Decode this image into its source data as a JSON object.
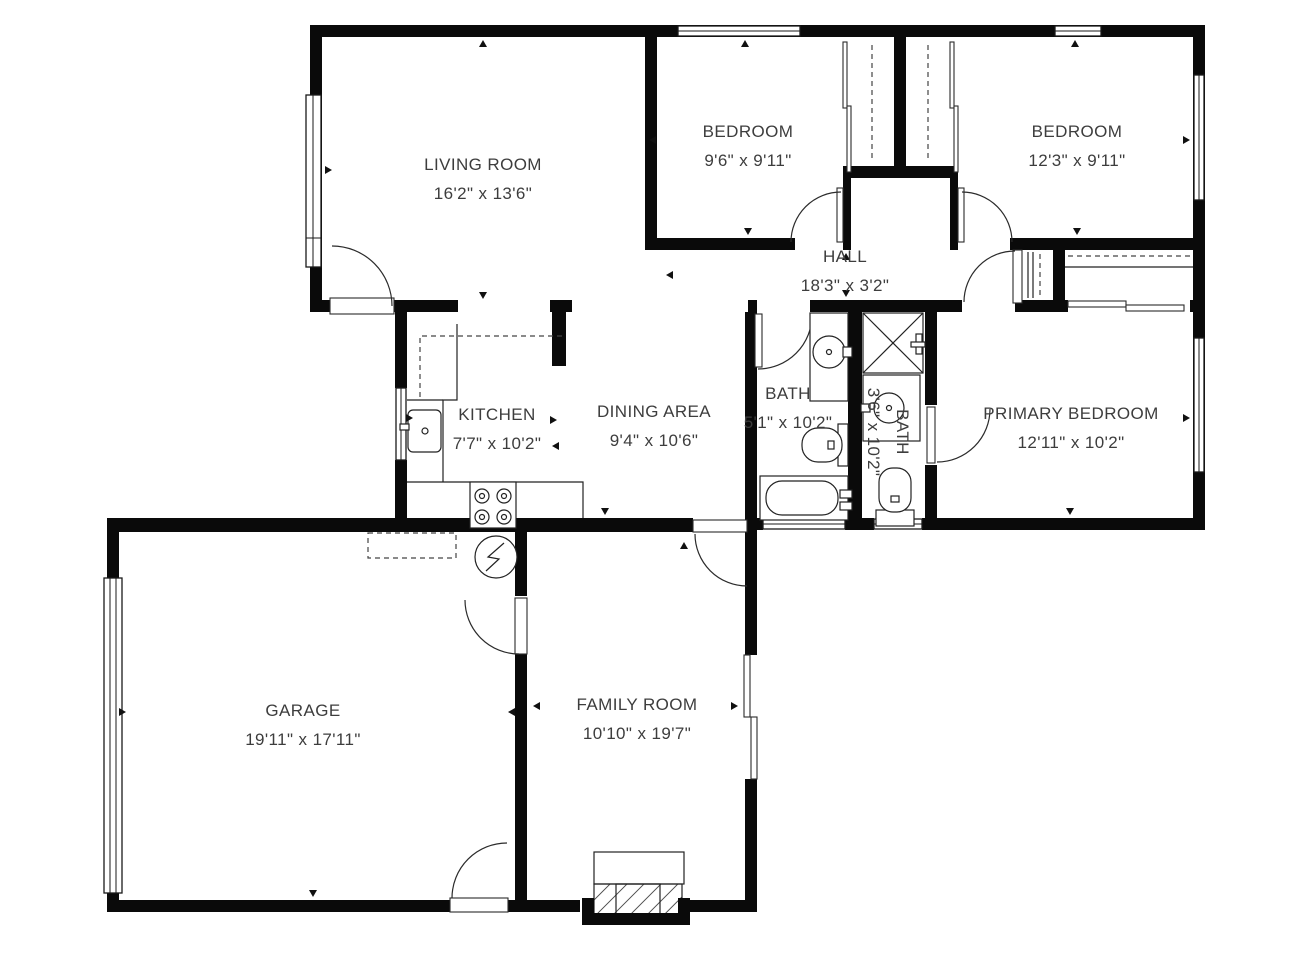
{
  "plan": {
    "background": "#ffffff",
    "wall_color": "#0a0a0a",
    "label_color": "#3d3d3d"
  },
  "rooms": [
    {
      "id": "living-room",
      "name": "LIVING ROOM",
      "dims": "16'2\" x 13'6\"",
      "cx": 483,
      "cy": 170,
      "rotate": 0
    },
    {
      "id": "bedroom-1",
      "name": "BEDROOM",
      "dims": "9'6\" x 9'11\"",
      "cx": 748,
      "cy": 137,
      "rotate": 0
    },
    {
      "id": "bedroom-2",
      "name": "BEDROOM",
      "dims": "12'3\" x 9'11\"",
      "cx": 1077,
      "cy": 137,
      "rotate": 0
    },
    {
      "id": "hall",
      "name": "HALL",
      "dims": "18'3\" x 3'2\"",
      "cx": 845,
      "cy": 262,
      "rotate": 0
    },
    {
      "id": "kitchen",
      "name": "KITCHEN",
      "dims": "7'7\" x 10'2\"",
      "cx": 497,
      "cy": 420,
      "rotate": 0
    },
    {
      "id": "dining-area",
      "name": "DINING AREA",
      "dims": "9'4\" x 10'6\"",
      "cx": 654,
      "cy": 417,
      "rotate": 0
    },
    {
      "id": "bath-1",
      "name": "BATH",
      "dims": "5'1\" x 10'2\"",
      "cx": 788,
      "cy": 399,
      "rotate": 0
    },
    {
      "id": "bath-2",
      "name": "BATH",
      "dims": "3'6\" x 10'2\"",
      "cx": 897,
      "cy": 432,
      "rotate": 90
    },
    {
      "id": "primary-bedroom",
      "name": "PRIMARY BEDROOM",
      "dims": "12'11\" x 10'2\"",
      "cx": 1071,
      "cy": 419,
      "rotate": 0
    },
    {
      "id": "garage",
      "name": "GARAGE",
      "dims": "19'11\" x 17'11\"",
      "cx": 303,
      "cy": 716,
      "rotate": 0
    },
    {
      "id": "family-room",
      "name": "FAMILY ROOM",
      "dims": "10'10\" x 19'7\"",
      "cx": 637,
      "cy": 710,
      "rotate": 0
    }
  ]
}
